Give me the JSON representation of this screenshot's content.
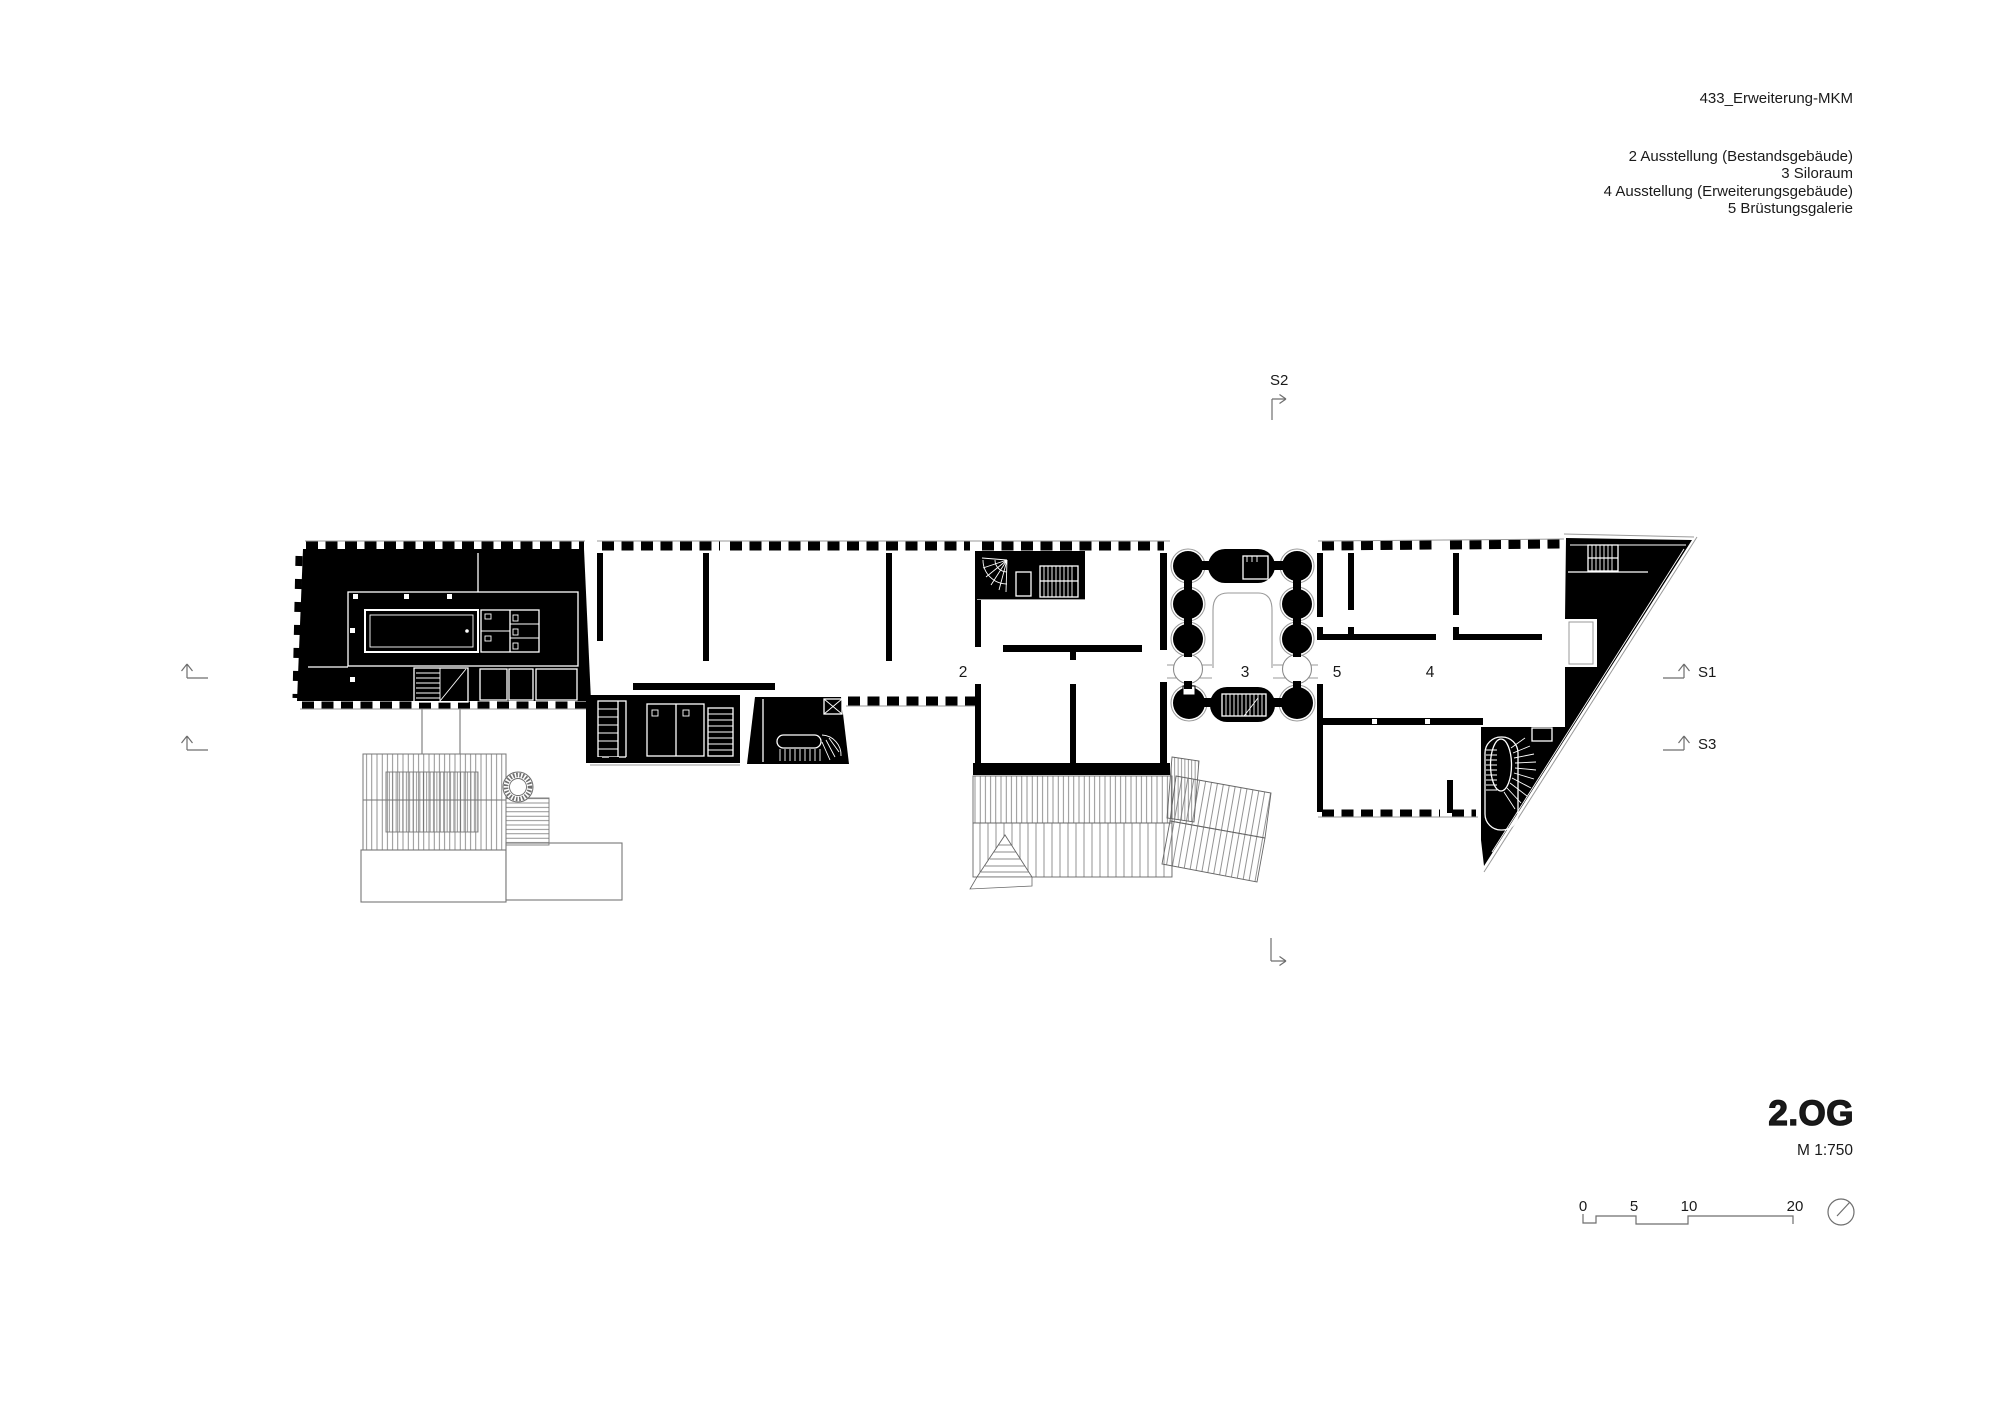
{
  "sheet": {
    "background": "#ffffff"
  },
  "header": {
    "project_title": "433_Erweiterung-MKM",
    "legend": [
      "2 Ausstellung (Bestandsgebäude)",
      "3 Siloraum",
      "4 Ausstellung (Erweiterungsgebäude)",
      "5 Brüstungsgalerie"
    ]
  },
  "plan": {
    "room_labels": {
      "ausstellung_bestand": "2",
      "siloraum": "3",
      "bruestungsgalerie": "5",
      "ausstellung_erweiterung": "4"
    },
    "section_markers": {
      "s1": "S1",
      "s2": "S2",
      "s3": "S3"
    }
  },
  "titleblock": {
    "floor_label": "2.OG",
    "scale_label": "M 1:750"
  },
  "scalebar": {
    "ticks": [
      "0",
      "5",
      "10",
      "20"
    ]
  },
  "colors": {
    "ink": "#000000",
    "line_gray": "#8c8c8c",
    "text": "#1a1a1a"
  }
}
